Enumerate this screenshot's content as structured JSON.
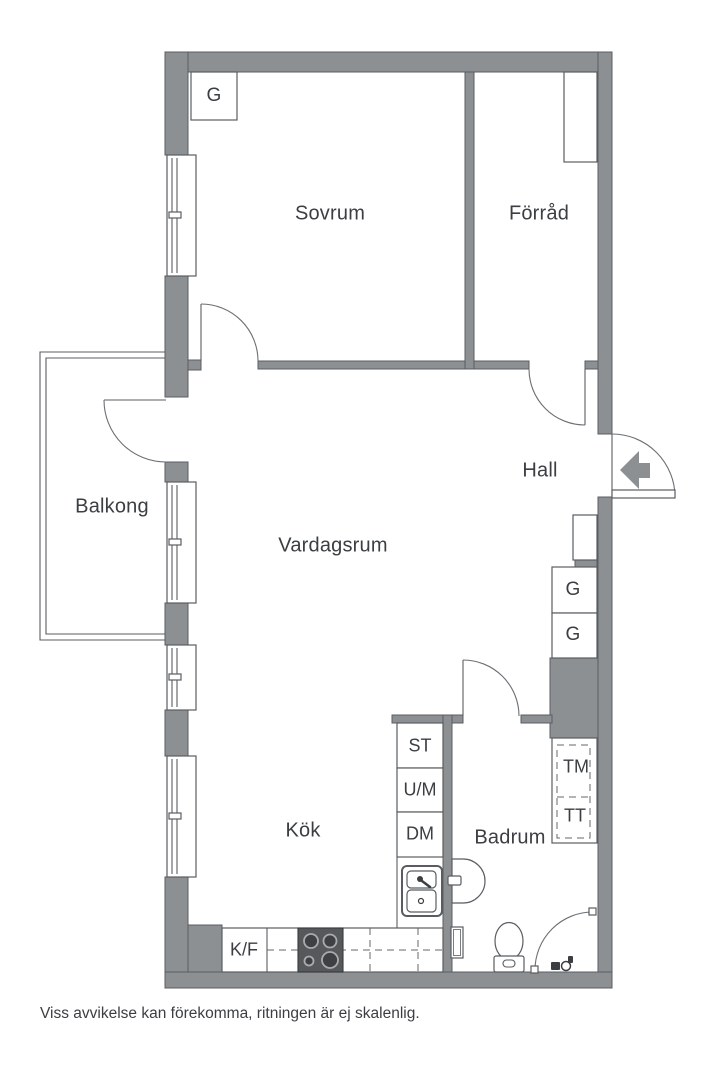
{
  "rooms": {
    "sovrum": {
      "label": "Sovrum"
    },
    "forrad": {
      "label": "Förråd"
    },
    "hall": {
      "label": "Hall"
    },
    "vardagsrum": {
      "label": "Vardagsrum"
    },
    "balkong": {
      "label": "Balkong"
    },
    "kok": {
      "label": "Kök"
    },
    "badrum": {
      "label": "Badrum"
    }
  },
  "fixtures": {
    "wardrobe_sovrum": {
      "label": "G"
    },
    "wardrobe_hall_upper": {
      "label": "G"
    },
    "wardrobe_hall_lower": {
      "label": "G"
    },
    "cleaning_cabinet": {
      "label": "ST"
    },
    "oven_micro": {
      "label": "U/M"
    },
    "dishwasher": {
      "label": "DM"
    },
    "fridge_freezer": {
      "label": "K/F"
    },
    "washing_machine": {
      "label": "TM"
    },
    "tumble_dryer": {
      "label": "TT"
    }
  },
  "footer": {
    "disclaimer": "Viss avvikelse kan förekomma, ritningen är ej skalenlig."
  },
  "colors": {
    "wall": "#8d9093",
    "outline": "#595d61",
    "text": "#3b3e42",
    "appliance_dark": "#56585a",
    "background": "#ffffff"
  }
}
